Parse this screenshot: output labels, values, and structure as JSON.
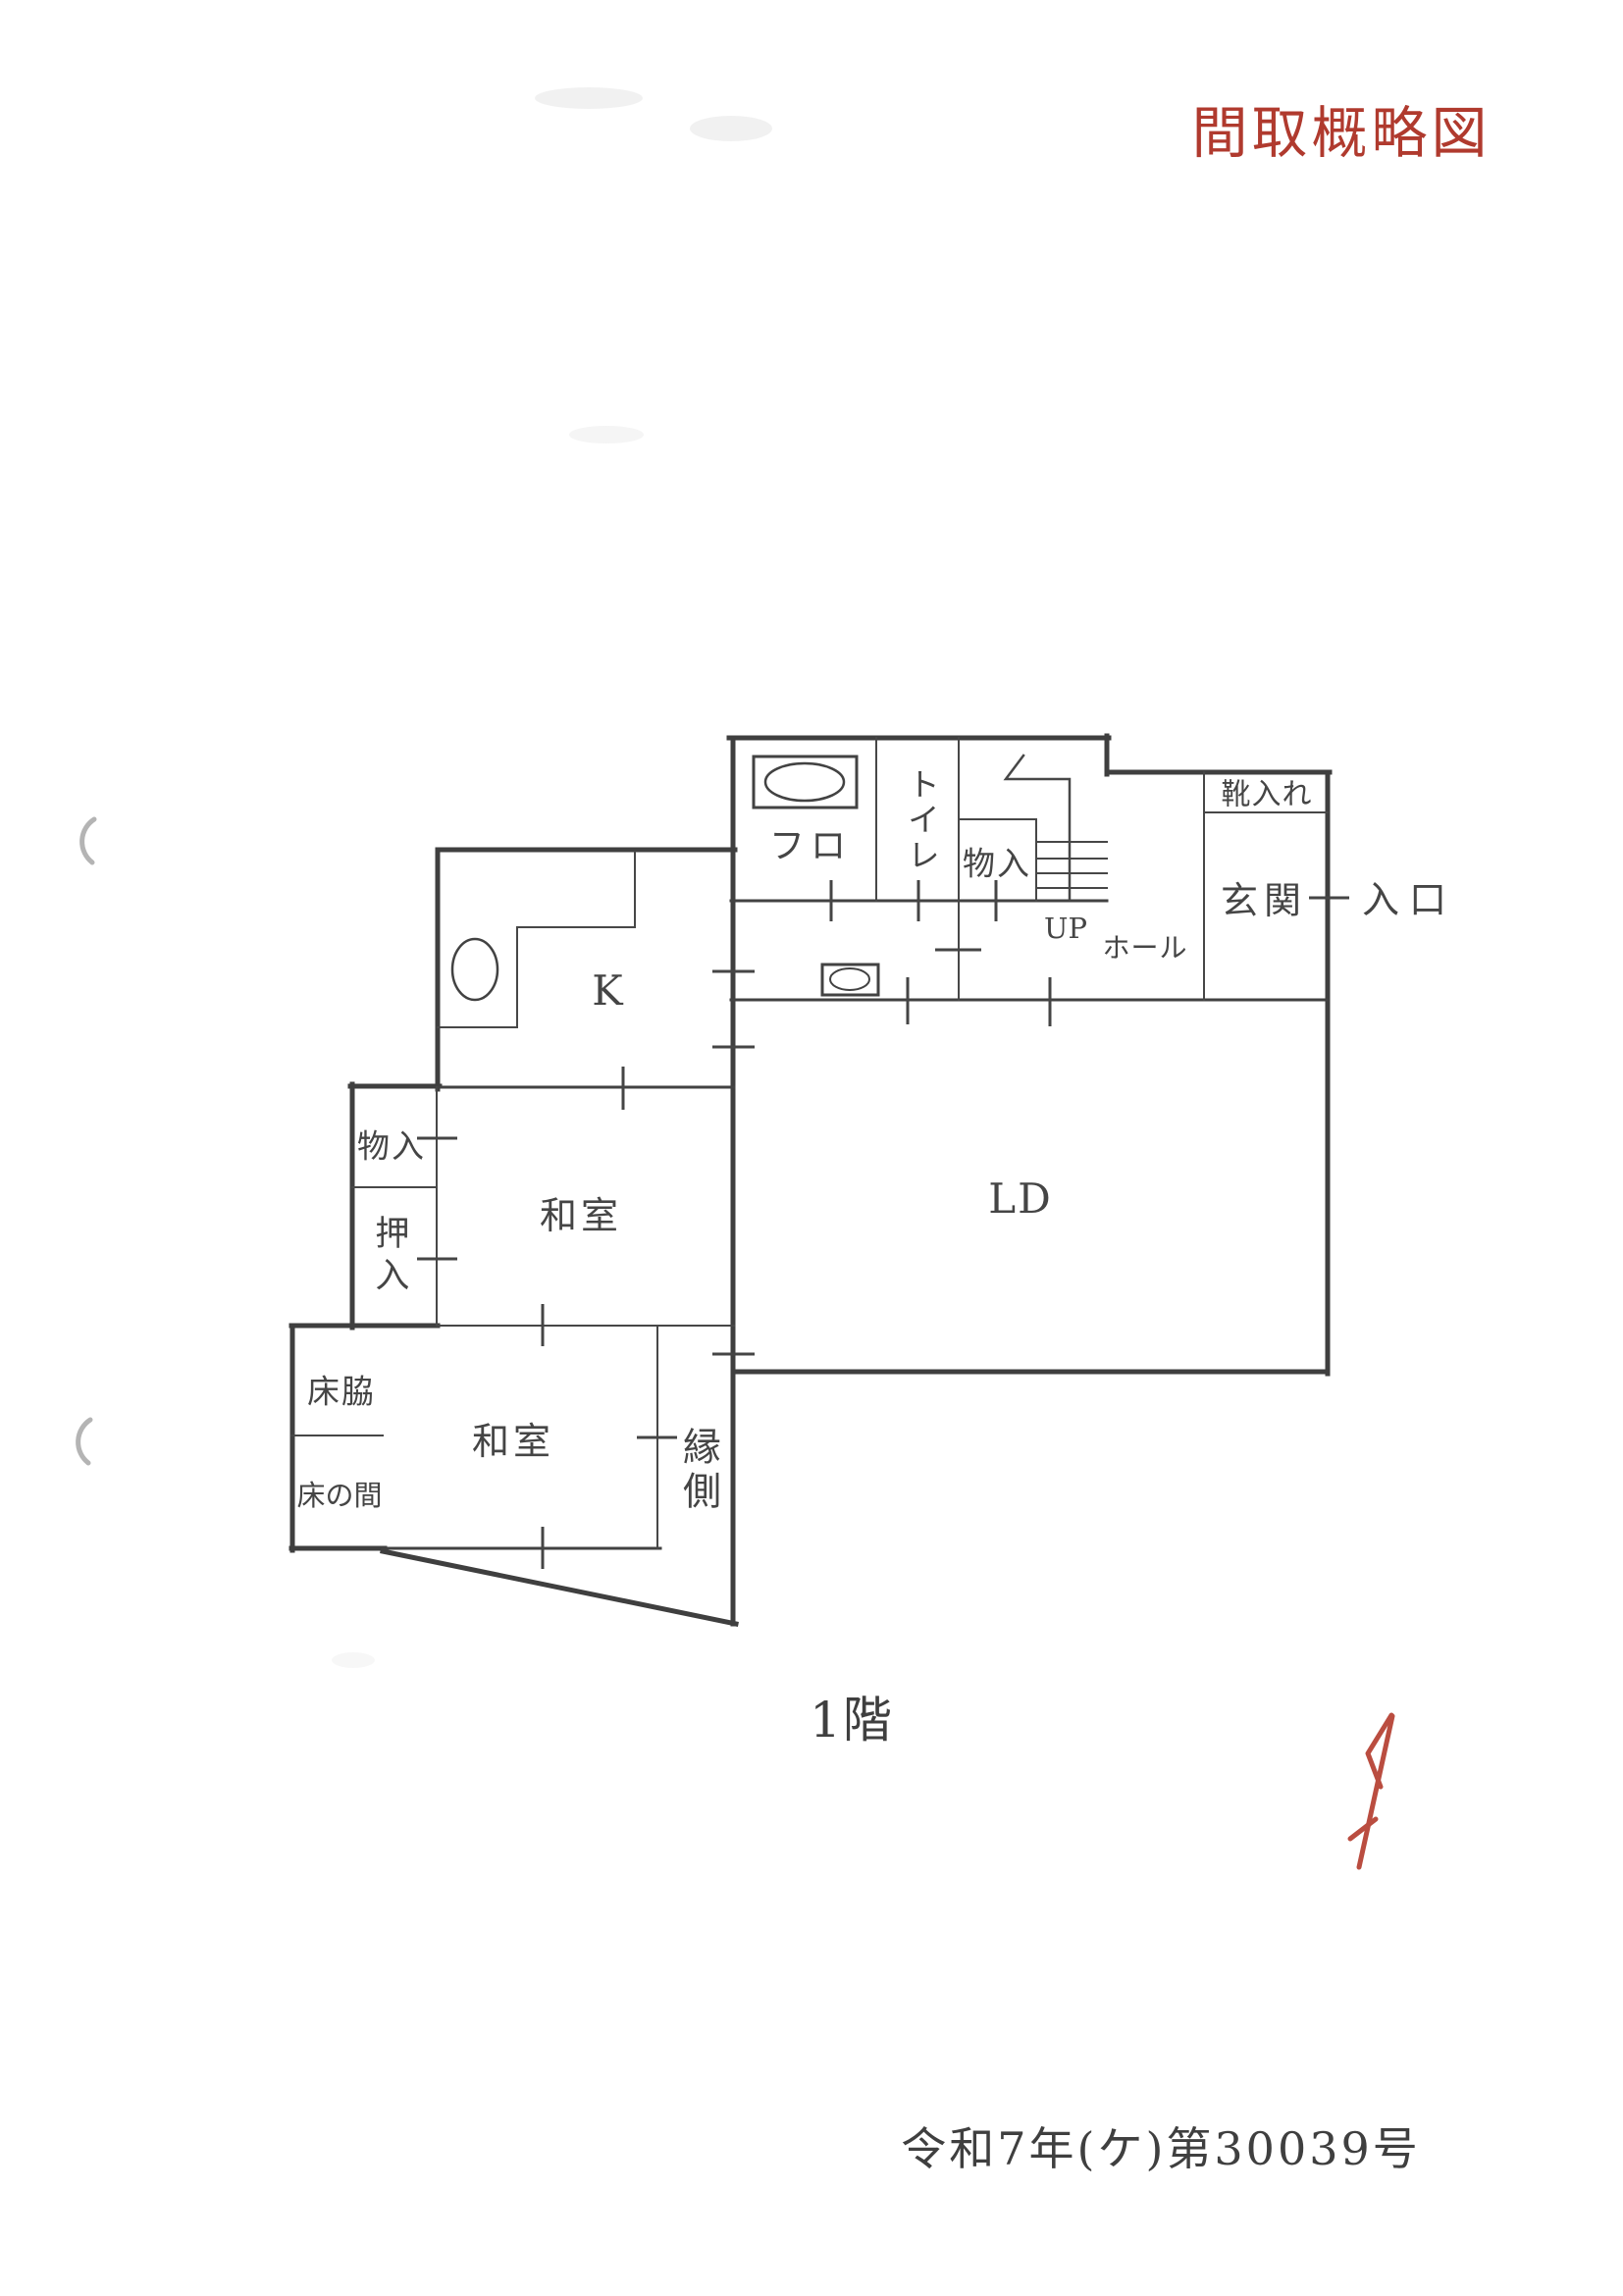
{
  "document": {
    "title": "間取概略図",
    "floor_caption": "1階",
    "case_number": "令和7年(ケ)第30039号"
  },
  "floorplan": {
    "rooms": {
      "bath": "フロ",
      "toilet": "トイレ",
      "storage_upper": "物入",
      "stairs_direction": "UP",
      "hall": "ホール",
      "shoe_cabinet": "靴入れ",
      "entrance_hall": "玄関",
      "entrance": "入口",
      "kitchen": "K",
      "living_dining": "LD",
      "japanese_room_1": "和室",
      "storage_side": "物入",
      "closet": "押入",
      "tokowaki": "床脇",
      "tokonoma": "床の間",
      "japanese_room_2": "和室",
      "engawa": "縁側"
    }
  },
  "colors": {
    "ink": "#3f3f3f",
    "accent_red": "#b03a2e",
    "handwriting_red": "#b33a2c"
  }
}
